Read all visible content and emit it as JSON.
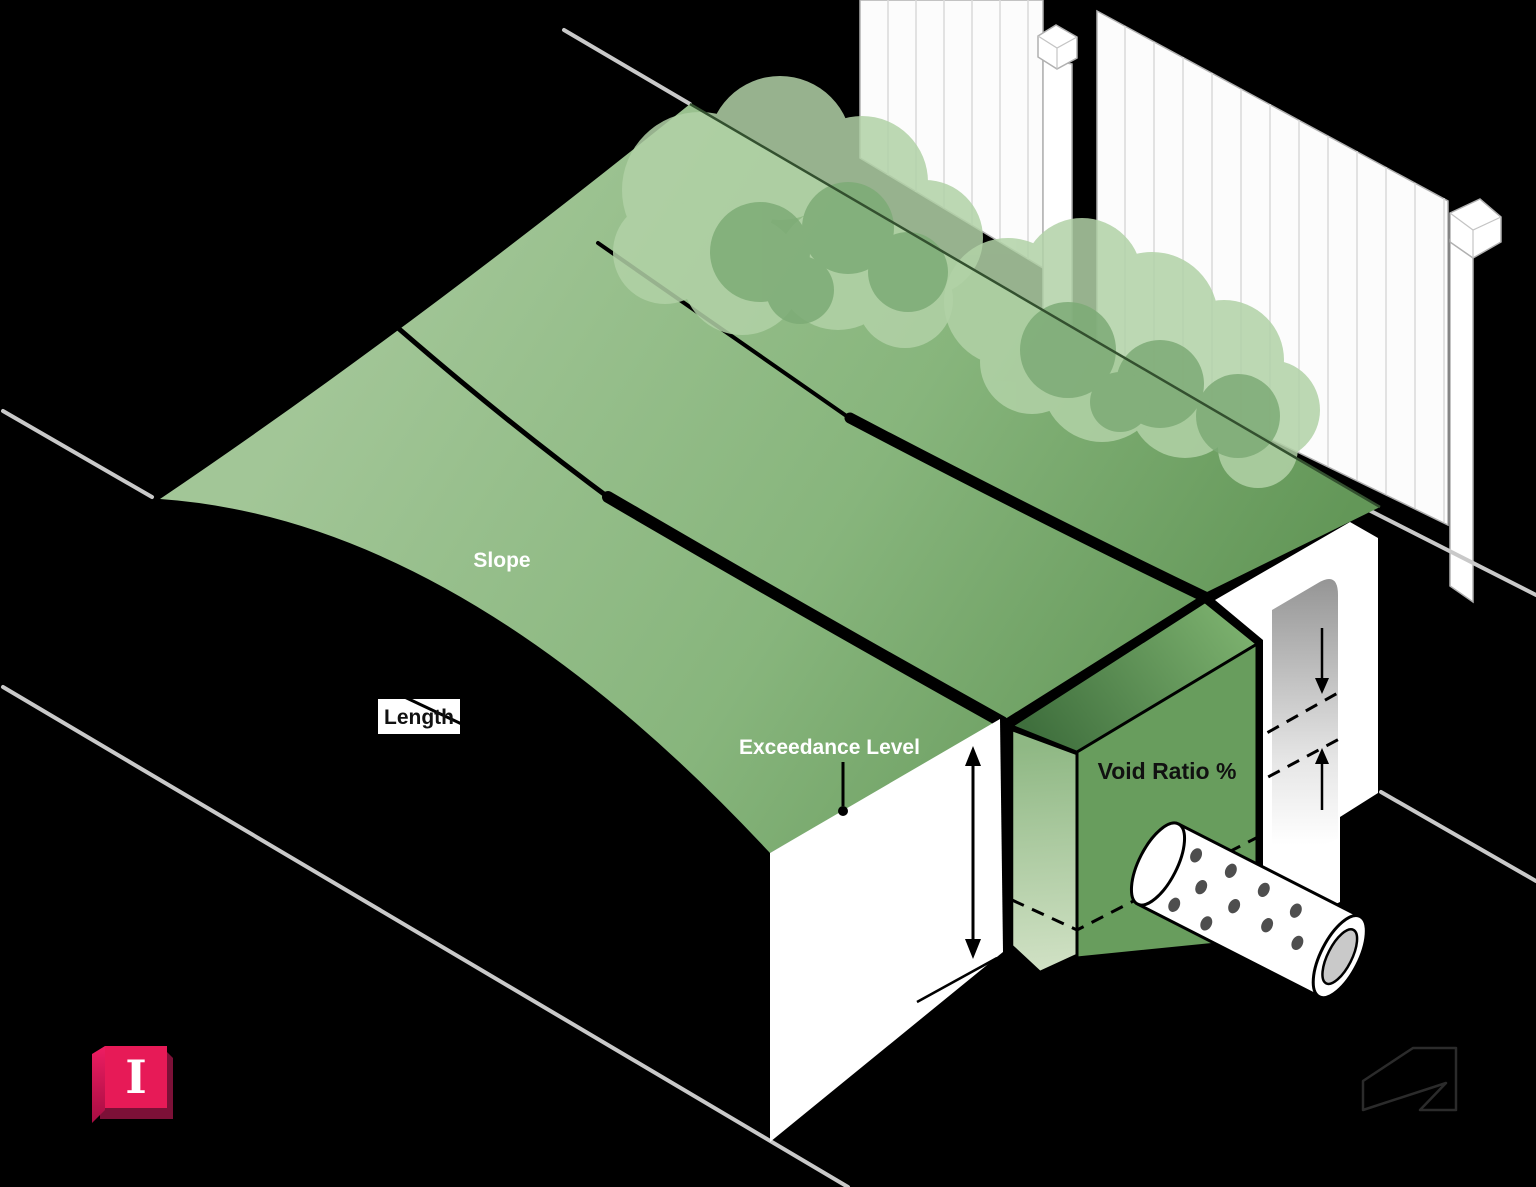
{
  "diagram": {
    "labels": {
      "slope": "Slope",
      "length": "Length",
      "exceedance_level": "Exceedance Level",
      "void_ratio": "Void Ratio %"
    },
    "logos": {
      "infodrainage_letter": "I",
      "infodrainage_icon": "pink-keycap-I-icon",
      "autodesk_icon": "autodesk-a-outline-icon"
    },
    "colors": {
      "background": "#000000",
      "slope_light": "#9fc494",
      "slope_dark": "#639758",
      "trench_end_face": "#689d5d",
      "bush_light": "#b2d2a7",
      "bush_dark": "#7dab76",
      "fence_white": "#fcfcfc",
      "dimension_gray": "#c9c9c9",
      "label_white": "#ffffff",
      "label_black": "#111111",
      "logo_pink": "#e71a57",
      "logo_pink_dark": "#7c1037"
    }
  }
}
